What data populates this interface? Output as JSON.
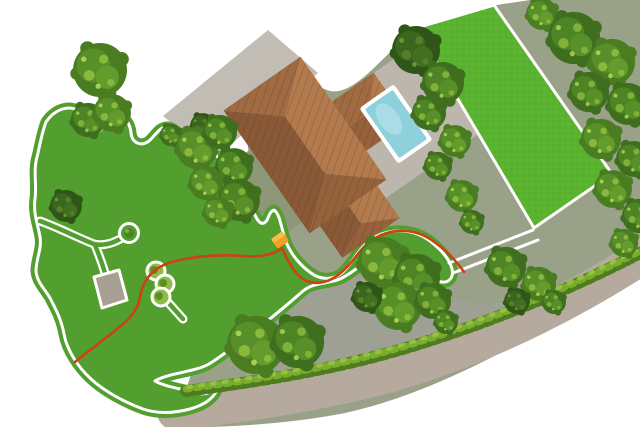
{
  "scene": {
    "type": "garden-plan-illustration",
    "features": [
      "main-lawn",
      "secondary-lawn",
      "house-roof",
      "garage",
      "swimming-pool",
      "pool-deck",
      "boundary-wire",
      "charging-station",
      "guide-corridor",
      "garden-path",
      "patio",
      "shrub-group",
      "tree",
      "hedge",
      "driveway",
      "perimeter-path",
      "terrain"
    ]
  },
  "colors": {
    "line": "#ffffff",
    "lawn": "#529e2e",
    "lawn2": "#5ab32e",
    "terrain": "#9aa189",
    "driveway": "#9da092",
    "sage": "#8e9879",
    "deck": "#bcb6ad",
    "garage": "#c1bcb4",
    "patio": "#a89f93",
    "pathTan": "#b5aa9d",
    "roofW": "#8a5a38",
    "roofE": "#b27a4d",
    "roofN": "#a06a42",
    "roofS": "#96623c",
    "pool": "#8ed0dc",
    "wire": "#cf4012",
    "station": "#f2a124",
    "stationTop": "#f7bd4b",
    "hedgeDark": "#4e7c1e",
    "hedgeLight": "#7aac2f",
    "hedgeHi": "#93c23d",
    "shrub": "#8fbc44",
    "shrubDark": "#5d8f28",
    "treeA1": "#4a7d22",
    "treeA2": "#578f28",
    "treeA3": "#639c2d",
    "treeA4": "#8ab83c",
    "treeA5": "#a8cf52",
    "treeB1": "#3f6f1e",
    "treeB2": "#4d8424",
    "treeB3": "#578f28",
    "treeB4": "#7fb039",
    "treeB5": "#9cc64a",
    "treeD1": "#2f5618",
    "treeD2": "#3a671d",
    "treeD3": "#417020",
    "treeD4": "#577f2a",
    "treeD5": "#6d9632"
  }
}
